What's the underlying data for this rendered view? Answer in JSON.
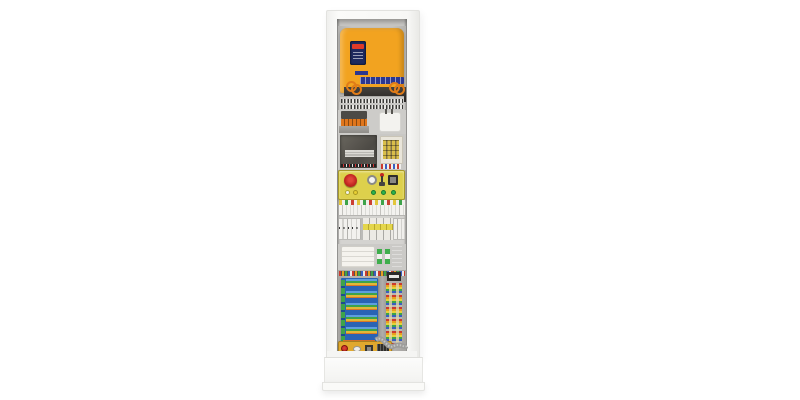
{
  "scene": {
    "type": "product-photo",
    "subject": "elevator control cabinet",
    "background_color": "#ffffff"
  },
  "labels": {
    "cabinet": "Tall white elevator control cabinet with open front",
    "vfd": "Orange variable-frequency drive with display",
    "vfd_display": "Drive display with red readout",
    "vfd_label_strip": "Blue product label strip",
    "terminal_plate": "Terminal strip plate",
    "transformer": "Control transformer with orange terminals",
    "filter_box": "White filter/power-supply box",
    "controller_module": "Dark metal controller module",
    "fuse_block": "Fuse/indicator block",
    "inspection_panel": "Yellow inspection panel",
    "estop": "Red emergency-stop mushroom button",
    "round_socket": "Round service socket",
    "toggle": "Toggle switch with red tip",
    "dark_socket": "Rectangular socket",
    "indicators": "White, yellow and green indicator buttons",
    "din_row_terminals": "DIN-rail terminal blocks",
    "din_row_breakers": "Circuit breakers and relays",
    "pcb_module_box": "White PCB module box",
    "green_terminal_minis": "Small green terminal modules",
    "blue_card": "Blue vertical card",
    "main_pcb": "Blue main controller PCB with colored wiring",
    "wire_column": "Vertical terminal column with multicolored wires",
    "connector_box": "Yellow connector box with red button",
    "ribbon_cable": "Gray ribbon cable loop",
    "plinth": "White cabinet plinth base"
  },
  "colors": {
    "frame": "#f8f8f6",
    "panel_gray": "#cfcecb",
    "vfd_body": "#f2a320",
    "vfd_display": "#1e2a5e",
    "vfd_readout": "#e03a28",
    "vfd_label_blue": "#2b3790",
    "terminal_green": "#2f9e42",
    "inspection_yellow": "#ddd04c",
    "estop_red": "#c32822",
    "indicator_green": "#2eb34a",
    "indicator_yellow": "#e6cf33",
    "indicator_white": "#f2f1ee",
    "pcb_blue": "#2a63b4",
    "connector_yellow": "#e0a82e",
    "ribbon_gray": "#9c9c9a",
    "base_white": "#fafaf8"
  }
}
